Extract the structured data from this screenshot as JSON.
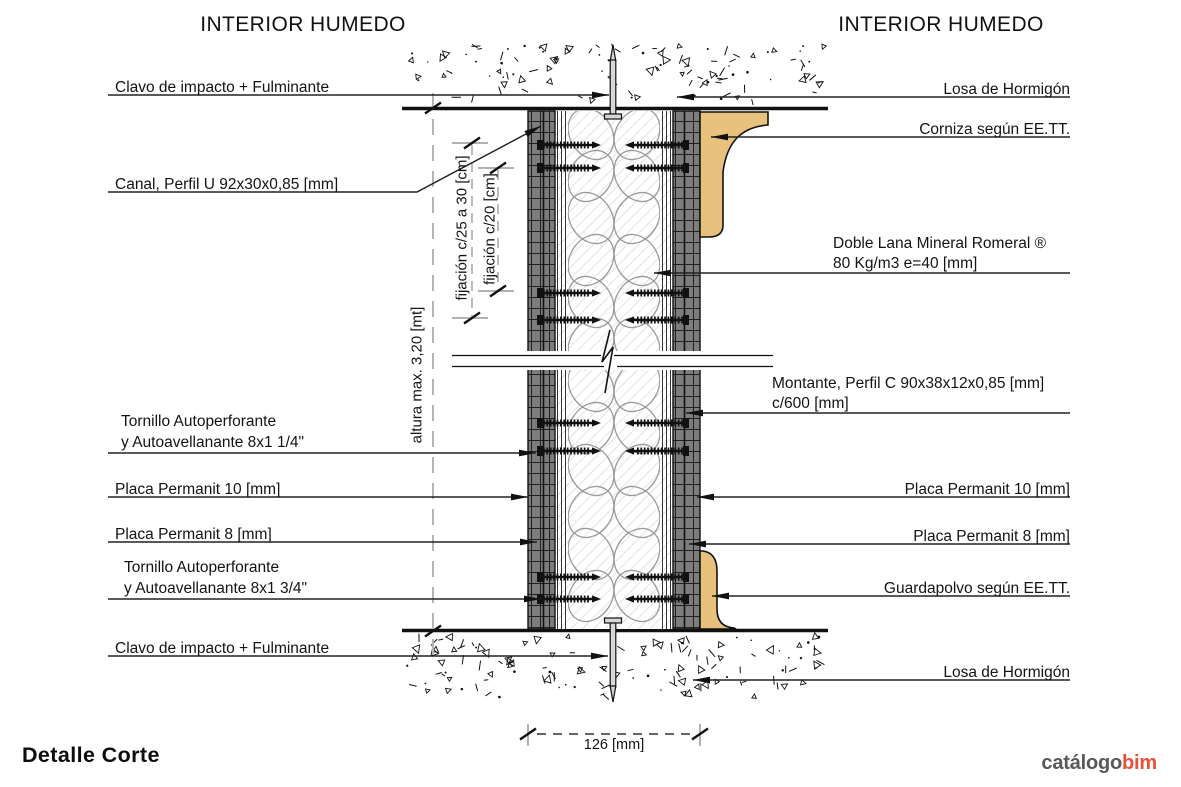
{
  "titles": {
    "left": "INTERIOR HUMEDO",
    "right": "INTERIOR HUMEDO"
  },
  "left_labels": {
    "clavo_top": "Clavo de impacto + Fulminante",
    "canal": "Canal, Perfil U 92x30x0,85 [mm]",
    "tornillo1_l1": "Tornillo Autoperforante",
    "tornillo1_l2": "y Autoavellanante 8x1 1/4\"",
    "placa10": "Placa Permanit 10 [mm]",
    "placa8": "Placa Permanit 8 [mm]",
    "tornillo2_l1": "Tornillo Autoperforante",
    "tornillo2_l2": "y Autoavellanante 8x1 3/4\"",
    "clavo_bottom": "Clavo de impacto + Fulminante"
  },
  "right_labels": {
    "losa_top": "Losa de Hormigón",
    "corniza": "Corniza según EE.TT.",
    "lana_l1": "Doble Lana Mineral Romeral ®",
    "lana_l2": "80 Kg/m3  e=40 [mm]",
    "montante_l1": "Montante, Perfil C 90x38x12x0,85 [mm]",
    "montante_l2": "c/600 [mm]",
    "placa10": "Placa Permanit 10 [mm]",
    "placa8": "Placa Permanit 8 [mm]",
    "guardapolvo": "Guardapolvo según EE.TT.",
    "losa_bottom": "Losa de Hormigón"
  },
  "dimensions": {
    "width": "126 [mm]",
    "height": "altura max. 3,20 [mt]",
    "fijacion_outer": "fijación c/25 a 30 [cm]",
    "fijacion_inner": "fijación c/20 [cm]"
  },
  "footer": {
    "title": "Detalle Corte"
  },
  "logo": {
    "gray": "catálogo",
    "accent": "bim"
  },
  "colors": {
    "cornice": "#e8c17d",
    "panel_gray": "#7d7d7d",
    "logo_gray": "#58595b",
    "logo_accent": "#e8503a"
  }
}
